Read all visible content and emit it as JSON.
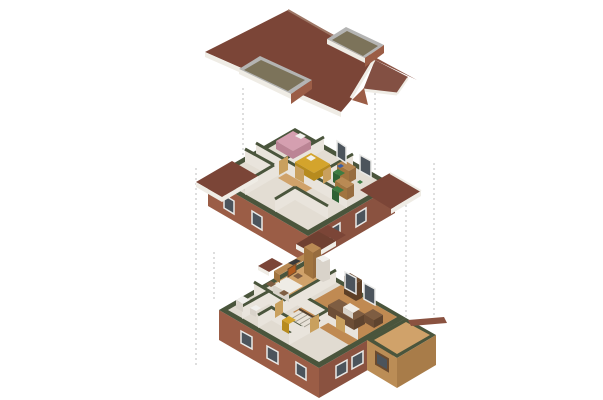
{
  "scene": {
    "type": "exploded-axonometric-house-diagram",
    "background": "#ffffff",
    "levels": [
      {
        "id": "roof",
        "label": "Roof",
        "features": [
          "brown shingle gable roof",
          "hip at rear end",
          "overhanging gable at right end",
          "cross-gable notch at lower right",
          "left shed dormer skylight",
          "right shed dormer skylight",
          "white fascia boards"
        ]
      },
      {
        "id": "upper-floor",
        "label": "Upper floor (cutaway)",
        "rooms": [
          "bedroom with pink bed",
          "bedroom with yellow bed",
          "study with desk and green chair",
          "second study desk with green chair",
          "bathroom with white fixtures",
          "corridor"
        ],
        "features": [
          "dark green cut wall caps",
          "brick exterior band with windows",
          "attached eave roof left",
          "attached eave roof right",
          "front porch gable"
        ]
      },
      {
        "id": "ground-floor",
        "label": "Ground floor (cutaway)",
        "rooms": [
          "kitchen with wood counters and tall cabinet",
          "dining room with white table and chairs",
          "living room with brown sofa, armchair, coffee table and shelf",
          "hallway with staircase",
          "wc with white fixtures",
          "timber-clad extension"
        ],
        "features": [
          "dark green cut wall caps",
          "brick exterior band with windows",
          "wood plank floors",
          "timber-sided extension with window",
          "garden wall ledge",
          "entry canopy"
        ]
      }
    ],
    "alignment_lines": {
      "style": "dashed",
      "count": 6,
      "color": "#bfbfbf"
    }
  },
  "palette": {
    "bg": "#ffffff",
    "roofBrown": "#7b4537",
    "roofBrownLight": "#8b5343",
    "roofBrownMid": "#835043",
    "roofBrownDark": "#6f4031",
    "ridgeLine": "#9d7665",
    "fascia": "#efece5",
    "brick": "#9b5d46",
    "brickDark": "#8a5240",
    "dormerTop": "#7c735a",
    "dormerFrame": "#b4b4b3",
    "capGreen": "#4a553c",
    "wallCream": "#e9e4dc",
    "wallShade": "#d9d3ca",
    "floorUpper": "#e3ddd3",
    "floorCream": "#e1dbd1",
    "floorWood": "#c08a52",
    "floorWoodLight": "#d0a26a",
    "doorTan": "#c9a05e",
    "bedPink": "#d59fb0",
    "bedPinkDark": "#bb8495",
    "bedYellow": "#d4a42c",
    "bedYellowDark": "#b78b1e",
    "chairGreen": "#3e7c42",
    "chairGreenDark": "#2f6234",
    "sofaBrown": "#7e5d42",
    "sofaBrownDark": "#6d4e36",
    "sofaBrownDarker": "#5f442f",
    "tableWhite": "#efece6",
    "cabinetWood": "#b98a54",
    "cabinetWoodDark": "#a1743f",
    "cabinetWoodDarker": "#976c3e",
    "shelfBrown": "#6b4a2e",
    "shelfBrownDark": "#5d3f26",
    "woodSiding": "#bb8d56",
    "woodSidingDark": "#a87c49",
    "glassDark": "#4c545c",
    "frameWhite": "#e9e9e7",
    "applianceWhite": "#f1f0ed",
    "accentOrange": "#b05c20",
    "accentBlue": "#3a5fa8",
    "cooktopDark": "#3a3a3a",
    "stairTread": "#e8e2d8",
    "stepLine": "#a09a8e",
    "railBrown": "#54412e",
    "dashGray": "#bdbdbd"
  }
}
